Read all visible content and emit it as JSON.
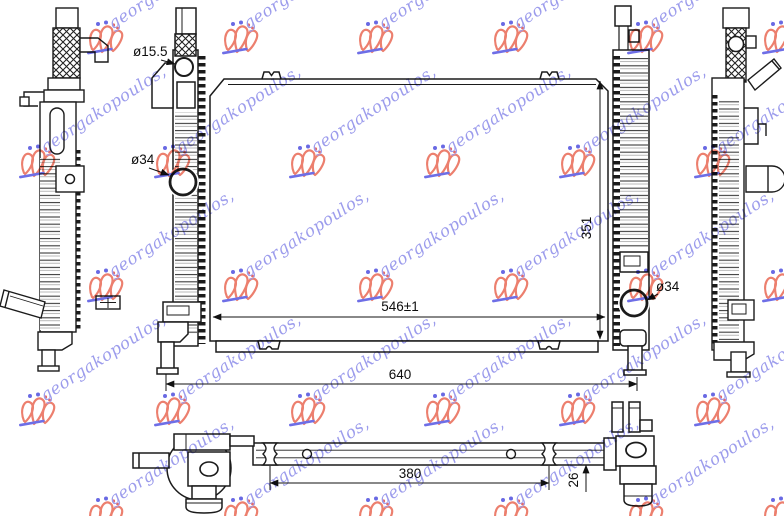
{
  "document": {
    "type": "technical-part-drawing",
    "subject": "radiator"
  },
  "dimensions": {
    "total_width": "640",
    "core_width": "546±1",
    "core_height": "351",
    "top_hole_diameter": "ø15.5",
    "left_hole_diameter": "ø34",
    "right_hole_diameter": "ø34",
    "bottom_mount_span": "380",
    "bottom_depth": "26"
  },
  "watermark": {
    "text": "georgakopoulos,",
    "text_color": "#8484e8",
    "logo_color": "#e8604a",
    "underline_color": "#4a4ae0",
    "dot_blue": "#4444dd",
    "dot_red": "#dd4444"
  },
  "colors": {
    "line": "#1b1b1b",
    "background": "#ffffff"
  }
}
